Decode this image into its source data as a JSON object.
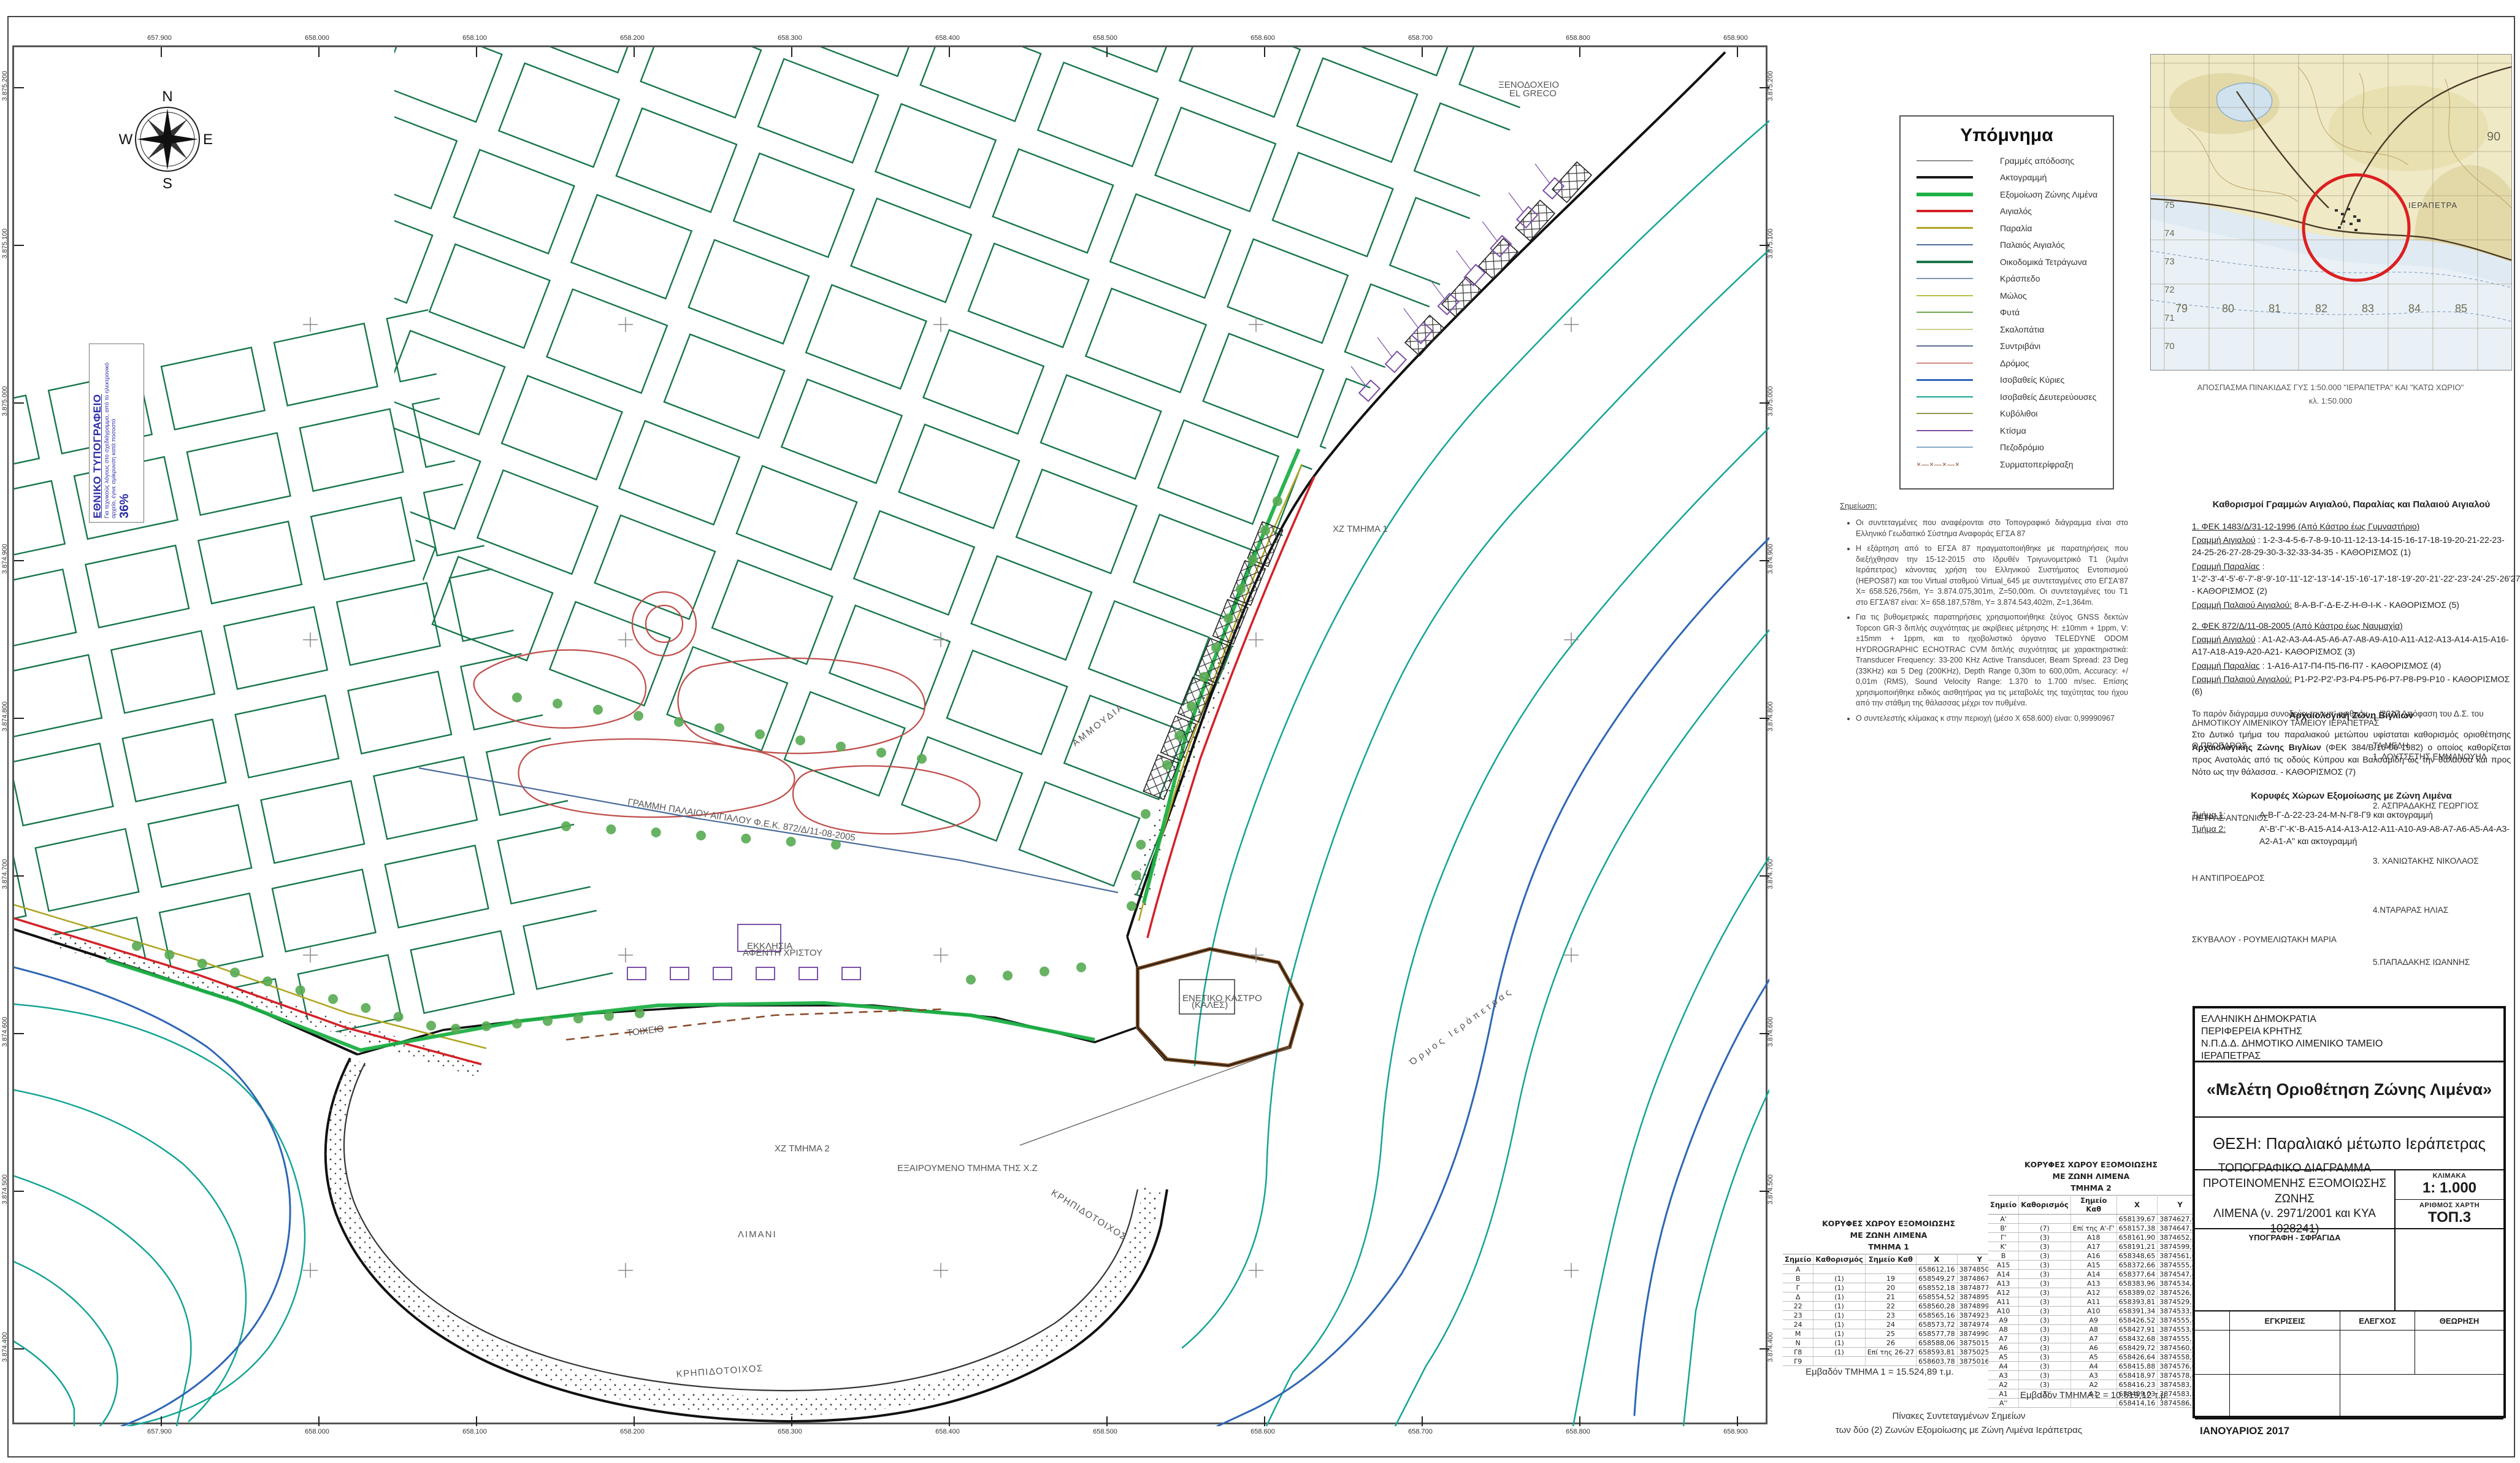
{
  "map": {
    "ticks_x": [
      "657.900",
      "658.000",
      "658.100",
      "658.200",
      "658.300",
      "658.400",
      "658.500",
      "658.600",
      "658.700",
      "658.800",
      "658.900"
    ],
    "ticks_y": [
      "3.875.200",
      "3.875.100",
      "3.875.000",
      "3.874.900",
      "3.874.800",
      "3.874.700",
      "3.874.600",
      "3.874.500",
      "3.874.400"
    ],
    "compass": {
      "n": "N",
      "e": "E",
      "s": "S",
      "w": "W"
    },
    "labels": {
      "limani": "ΛΙΜΑΝΙ",
      "ammoudia": "ΑΜΜΟΥΔΙΑ",
      "xz1": "ΧΖ ΤΜΗΜΑ 1",
      "xz2": "ΧΖ ΤΜΗΜΑ 2",
      "exair": "ΕΞΑΙΡΟΥΜΕΝΟ ΤΜΗΜΑ ΤΗΣ Χ.Ζ",
      "ormos": "Όρμος Ιεράπετρας",
      "krip1": "ΚΡΗΠΙΔΟΤΟΙΧΟΣ",
      "krip2": "ΚΡΗΠΙΔΟΤΟΙΧΟΣ",
      "hotel1": "ΞΕΝΟΔΟΧΕΙΟ",
      "hotel2": "EL GRECO",
      "kastro1": "ΕΝΕΤΙΚΟ ΚΑΣΤΡΟ",
      "kastro2": "(ΚΑΛΕΣ)",
      "church1": "ΕΚΚΛΗΣΙΑ",
      "church2": "ΑΦΕΝΤΗ ΧΡΙΣΤΟΥ",
      "palaios": "ΓΡΑΜΜΗ ΠΑΛΑΙΟΥ ΑΙΓΙΑΛΟΥ  Φ.Ε.Κ. 872/Δ/11-08-2005",
      "toixeio": "ΤΟΙΧΕΙΟ"
    }
  },
  "stamp": {
    "title": "ΕΘΝΙΚΟ ΤΥΠΟΓΡΑΦΕΙΟ",
    "body": "Για τεχνικούς λόγους στο σχεδιάγραμμα, από το ηλεκτρονικό αρχείο, έγινε σμίκρυνση κατά ποσοστό",
    "pct": "36%"
  },
  "legend": {
    "title": "Υπόμνημα",
    "items": [
      {
        "label": "Γραμμές απόδοσης",
        "color": "#8f8f8f",
        "weight": 2,
        "style": "solid"
      },
      {
        "label": "Ακτογραμμή",
        "color": "#1a1a1a",
        "weight": 4,
        "style": "solid"
      },
      {
        "label": "Εξομοίωση Ζώνης Λιμένα",
        "color": "#1db046",
        "weight": 6,
        "style": "solid"
      },
      {
        "label": "Αιγιαλός",
        "color": "#d42127",
        "weight": 4,
        "style": "solid"
      },
      {
        "label": "Παραλία",
        "color": "#b0a623",
        "weight": 3,
        "style": "solid"
      },
      {
        "label": "Παλαιός Αιγιαλός",
        "color": "#4a6d9b",
        "weight": 2,
        "style": "solid"
      },
      {
        "label": "Οικοδομικά Τετράγωνα",
        "color": "#17764a",
        "weight": 4,
        "style": "solid"
      },
      {
        "label": "Κράσπεδο",
        "color": "#7d97b5",
        "weight": 2,
        "style": "solid"
      },
      {
        "label": "Μώλος",
        "color": "#b9c145",
        "weight": 2,
        "style": "solid"
      },
      {
        "label": "Φυτά",
        "color": "#68a94d",
        "weight": 2,
        "style": "solid"
      },
      {
        "label": "Σκαλοπάτια",
        "color": "#cbcf8d",
        "weight": 2,
        "style": "solid"
      },
      {
        "label": "Συντριβάνι",
        "color": "#5d6d92",
        "weight": 2,
        "style": "solid"
      },
      {
        "label": "Δρόμος",
        "color": "#d48a86",
        "weight": 2,
        "style": "solid"
      },
      {
        "label": "Ισοβαθείς Κύριες",
        "color": "#2e66b5",
        "weight": 3,
        "style": "solid"
      },
      {
        "label": "Ισοβαθείς Δευτερεύουσες",
        "color": "#14a493",
        "weight": 2,
        "style": "solid"
      },
      {
        "label": "Κυβόλιθοι",
        "color": "#97984e",
        "weight": 2,
        "style": "solid"
      },
      {
        "label": "Κτίσμα",
        "color": "#7b4fa6",
        "weight": 2,
        "style": "solid"
      },
      {
        "label": "Πεζοδρόμιο",
        "color": "#88a9c8",
        "weight": 2,
        "style": "solid"
      },
      {
        "label": "Συρματοπερίφραξη",
        "color": "#8a4a2a",
        "weight": 2,
        "style": "fence"
      }
    ]
  },
  "inset": {
    "caption1": "ΑΠΟΣΠΑΣΜΑ ΠΙΝΑΚΙΔΑΣ ΓΥΣ 1:50.000 \"ΙΕΡΑΠΕΤΡΑ\" ΚΑΙ \"ΚΑΤΩ ΧΩΡΙΟ\"",
    "caption2": "κλ. 1:50.000",
    "bottom_numbers": [
      "79",
      "80",
      "81",
      "82",
      "83",
      "84",
      "85"
    ],
    "left_numbers": [
      "75",
      "74",
      "73",
      "72",
      "71",
      "70"
    ],
    "right_number": "90",
    "town_label": "ΙΕΡΑΠΕΤΡΑ"
  },
  "notes": {
    "heading": "Σημείωση:",
    "bullets": [
      "Οι συντεταγμένες που αναφέρονται στο Τοπογραφικό διάγραμμα είναι στο Ελληνικό Γεωδαιτικό Σύστημα Αναφοράς ΕΓΣΑ 87",
      "Η εξάρτηση από το ΕΓΣΑ 87 πραγματοποιήθηκε με παρατηρήσεις που διεξήχθησαν την 15-12-2015 στο Ιδρυθέν Τριγωνομετρικό Τ1 (λιμάνι Ιεράπετρας) κάνοντας χρήση του Ελληνικού Συστήματος Εντοπισμού (HEPOS87) και του Virtual σταθμού Virtual_645 με συντεταγμένες στο ΕΓΣΑ'87 X= 658.526,756m, Y= 3.874.075,301m, Z=50,00m. Οι συντεταγμένες του Τ1 στο ΕΓΣΑ'87 είναι: X= 658.187,578m, Y= 3.874.543,402m, Z=1,364m.",
      "Για τις βυθομετρικές παρατηρήσεις χρησιμοποιήθηκε ζεύγος GNSS δεκτών Topcon GR-3 διπλής συχνότητας με ακρίβειες μέτρησης H: ±10mm + 1ppm, V: ±15mm + 1ppm, και το ηχοβολιστικό όργανο TELEDYNE ODOM HYDROGRAPHIC ECHOTRAC CVM διπλής συχνότητας με χαρακτηριστικά: Transducer Frequency: 33-200 KHz Active Transducer, Beam Spread: 23 Deg (33KHz) και 5 Deg (200KHz), Depth Range 0,30m to 600,00m, Accuracy: +/ 0,01m (RMS), Sound Velocity Range: 1.370 to 1.700 m/sec. Επίσης χρησιμοποιήθηκε ειδικός αισθητήρας για τις μεταβολές της ταχύτητας του ήχου από την στάθμη της θάλασσας μέχρι τον πυθμένα.",
      "Ο συντελεστής κλίμακας κ στην περιοχή (μέσο X 658.600) είναι: 0,99990967"
    ]
  },
  "fek": {
    "title": "Καθορισμοί Γραμμών Αιγιαλού, Παραλίας και Παλαιού Αιγιαλού",
    "s1_heading": "1. ΦΕΚ 1483/Δ/31-12-1996 (Από Κάστρο έως Γυμναστήριο)",
    "s1_l1_label": "Γραμμή Αιγιαλού",
    "s1_l1_text": " : 1-2-3-4-5-6-7-8-9-10-11-12-13-14-15-16-17-18-19-20-21-22-23-24-25-26-27-28-29-30-3-32-33-34-35 - ΚΑΘΟΡΙΣΜΟΣ (1)",
    "s1_l2_label": "Γραμμή Παραλίας",
    "s1_l2_text": " : 1'-2'-3'-4'-5'-6'-7'-8'-9'-10'-11'-12'-13'-14'-15'-16'-17'-18'-19'-20'-21'-22'-23'-24'-25'-26'27' - ΚΑΘΟΡΙΣΜΟΣ (2)",
    "s1_l3_label": "Γραμμή Παλαιού Αιγιαλού:",
    "s1_l3_text": " 8-Α-Β-Γ-Δ-Ε-Ζ-Η-Θ-Ι-Κ - ΚΑΘΟΡΙΣΜΟΣ (5)",
    "s2_heading": "2. ΦΕΚ 872/Δ/11-08-2005 (Από Κάστρο έως Ναυμαχία)",
    "s2_l1_label": "Γραμμή Αιγιαλού",
    "s2_l1_text": " :  Α1-Α2-Α3-Α4-Α5-Α6-Α7-Α8-Α9-Α10-Α11-Α12-Α13-Α14-Α15-Α16-Α17-Α18-Α19-Α20-Α21- ΚΑΘΟΡΙΣΜΟΣ (3)",
    "s2_l2_label": "Γραμμή Παραλίας",
    "s2_l2_text": " : 1-Α16-Α17-Π4-Π5-Π6-Π7 - ΚΑΘΟΡΙΣΜΟΣ (4)",
    "s2_l3_label": "Γραμμή Παλαιού Αιγιαλού:",
    "s2_l3_text": " Ρ1-Ρ2-Ρ2'-Ρ3-Ρ4-Ρ5-Ρ6-Ρ7-Ρ8-Ρ9-Ρ10 - ΚΑΘΟΡΙΣΜΟΣ (6)",
    "arch_title": "Αρχαιολογική Ζώνη Βιγλίων",
    "arch_body_1": "Στο Δυτικό τμήμα του παραλιακού μετώπου υφίσταται καθορισμός οριοθέτησης ",
    "arch_body_bold": "Αρχαιολογικής Ζώνης Βιγλίων ",
    "arch_body_2": "(ΦΕΚ 384/Β/16-06-1982) ο οποίος καθορίζεται προς Ανατολάς από τις οδούς Κύπρου και Βαλσαμίδη ως την θάλασσα και προς Νότο ως την θάλασσα. - ΚΑΘΟΡΙΣΜΟΣ (7)",
    "peaks_title": "Κορυφές Χώρων Εξομοίωσης με Ζώνη Λιμένα",
    "p1_label": "Τμήμα  1:",
    "p1_text": "Α-Β-Γ-Δ-22-23-24-Μ-Ν-Γ8-Γ9 και ακτογραμμή",
    "p2_label": "Τμήμα  2:",
    "p2_text": "Α'-Β'-Γ'-Κ'-Β-Α15-Α14-Α13-Α12-Α11-Α10-Α9-Α8-Α7-Α6-Α5-Α4-Α3-Α2-Α1-Α'' και ακτογραμμή"
  },
  "signatures": {
    "intro1": "Το παρόν διάγραμμα συνοδεύει την υπ' αριθμόν __/2017 Απόφαση του Δ.Σ. του",
    "intro2": "ΔΗΜΟΤΙΚΟΥ ΛΙΜΕΝΙΚΟΥ ΤΑΜΕΙΟΥ ΙΕΡΑΠΕΤΡΑΣ",
    "president_title": "Ο ΠΡΟΕΔΡΟΣ",
    "president_name": "ΠΕΤΡΑΣ ΑΝΤΩΝΙΟΣ",
    "vice_title": "Η ΑΝΤΙΠΡΟΕΔΡΟΣ",
    "vice_name": "ΣΚΥΒΑΛΟΥ - ΡΟΥΜΕΛΙΩΤΑΚΗ ΜΑΡΙΑ",
    "members_title": "ΤΑ ΜΕΛΗ",
    "members": [
      "1. ΛΟΥΤΣΕΤΗΣ ΕΜΜΑΝΟΥΗΛ",
      "2. ΑΣΠΡΑΔΑΚΗΣ ΓΕΩΡΓΙΟΣ",
      "3. ΧΑΝΙΩΤΑΚΗΣ ΝΙΚΟΛΑΟΣ",
      "4.ΝΤΑΡΑΡΑΣ ΗΛΙΑΣ",
      "5.ΠΑΠΑΔΑΚΗΣ ΙΩΑΝΝΗΣ"
    ]
  },
  "tables": {
    "columns": [
      "Σημείο",
      "Καθορισμός",
      "Σημείο Καθ",
      "X",
      "Y"
    ],
    "t1": {
      "title1": "ΚΟΡΥΦΕΣ ΧΩΡΟΥ ΕΞΟΜΟΙΩΣΗΣ",
      "title2": "ΜΕ ΖΩΝΗ ΛΙΜΕΝΑ",
      "title3": "ΤΜΗΜΑ 1",
      "rows": [
        [
          "Α",
          "",
          "",
          "658612,16",
          "3874850,98"
        ],
        [
          "Β",
          "(1)",
          "19",
          "658549,27",
          "3874867,70"
        ],
        [
          "Γ",
          "(1)",
          "20",
          "658552,18",
          "3874877,86"
        ],
        [
          "Δ",
          "(1)",
          "21",
          "658554,52",
          "3874895,15"
        ],
        [
          "22",
          "(1)",
          "22",
          "658560,28",
          "3874899,80"
        ],
        [
          "23",
          "(1)",
          "23",
          "658565,16",
          "3874923,81"
        ],
        [
          "24",
          "(1)",
          "24",
          "658573,72",
          "3874974,08"
        ],
        [
          "Μ",
          "(1)",
          "25",
          "658577,78",
          "3874990,64"
        ],
        [
          "Ν",
          "(1)",
          "26",
          "658588,06",
          "3875015,24"
        ],
        [
          "Γ8",
          "(1)",
          "Επί της 26-27",
          "658593,81",
          "3875025,29"
        ],
        [
          "Γ9",
          "",
          "",
          "658603,78",
          "3875016,38"
        ]
      ],
      "area": "Εμβαδόν ΤΜΗΜΑ 1 = 15.524,89 τ.μ."
    },
    "t2": {
      "title1": "ΚΟΡΥΦΕΣ ΧΩΡΟΥ ΕΞΟΜΟΙΩΣΗΣ",
      "title2": "ΜΕ ΖΩΝΗ ΛΙΜΕΝΑ",
      "title3": "ΤΜΗΜΑ 2",
      "rows": [
        [
          "Α'",
          "",
          "",
          "658139,67",
          "3874627,00"
        ],
        [
          "Β'",
          "(7)",
          "Επί της Α'-Γ'",
          "658157,38",
          "3874647,21"
        ],
        [
          "Γ'",
          "(3)",
          "Α18",
          "658161,90",
          "3874652,36"
        ],
        [
          "Κ'",
          "(3)",
          "Α17",
          "658191,21",
          "3874599,98"
        ],
        [
          "Β",
          "(3)",
          "Α16",
          "658348,65",
          "3874561,61"
        ],
        [
          "Α15",
          "(3)",
          "Α15",
          "658372,66",
          "3874555,41"
        ],
        [
          "Α14",
          "(3)",
          "Α14",
          "658377,64",
          "3874547,43"
        ],
        [
          "Α13",
          "(3)",
          "Α13",
          "658383,96",
          "3874534,49"
        ],
        [
          "Α12",
          "(3)",
          "Α12",
          "658389,02",
          "3874526,32"
        ],
        [
          "Α11",
          "(3)",
          "Α11",
          "658393,81",
          "3874529,14"
        ],
        [
          "Α10",
          "(3)",
          "Α10",
          "658391,34",
          "3874533,57"
        ],
        [
          "Α9",
          "(3)",
          "Α9",
          "658426,52",
          "3874555,42"
        ],
        [
          "Α8",
          "(3)",
          "Α8",
          "658427,91",
          "3874553,08"
        ],
        [
          "Α7",
          "(3)",
          "Α7",
          "658432,68",
          "3874555,75"
        ],
        [
          "Α6",
          "(3)",
          "Α6",
          "658429,72",
          "3874560,68"
        ],
        [
          "Α5",
          "(3)",
          "Α5",
          "658426,64",
          "3874558,90"
        ],
        [
          "Α4",
          "(3)",
          "Α4",
          "658415,88",
          "3874576,69"
        ],
        [
          "Α3",
          "(3)",
          "Α3",
          "658418,97",
          "3874578,44"
        ],
        [
          "Α2",
          "(3)",
          "Α2",
          "658416,23",
          "3874583,12"
        ],
        [
          "Α1",
          "(3)",
          "Α1",
          "658409,03",
          "3874583,88"
        ],
        [
          "Α''",
          "",
          "",
          "658414,16",
          "3874586,77"
        ]
      ],
      "area": "Εμβαδόν ΤΜΗΜΑ 2 = 10.619,12 τ.μ."
    },
    "caption1": "Πίνακες Συντεταγμένων Σημείων",
    "caption2": "των δύο (2) Ζωνών Εξομοίωσης με Ζώνη Λιμένα Ιεράπετρας"
  },
  "titleblock": {
    "agency": [
      "ΕΛΛΗΝΙΚΗ ΔΗΜΟΚΡΑΤΙΑ",
      "ΠΕΡΙΦΕΡΕΙΑ ΚΡΗΤΗΣ",
      "Ν.Π.Δ.Δ. ΔΗΜΟΤΙΚΟ ΛΙΜΕΝΙΚΟ ΤΑΜΕΙΟ",
      "ΙΕΡΑΠΕΤΡΑΣ"
    ],
    "project": "«Μελέτη  Οριοθέτηση Ζώνης Λιμένα»",
    "location": "ΘΕΣΗ: Παραλιακό μέτωπο Ιεράπετρας",
    "drawing1": "ΤΟΠΟΓΡΑΦΙΚΟ ΔΙΑΓΡΑΜΜΑ",
    "drawing2": "ΠΡΟΤΕΙΝΟΜΕΝΗΣ ΕΞΟΜΟΙΩΣΗΣ ΖΩΝΗΣ",
    "drawing3": "ΛΙΜΕΝΑ (ν. 2971/2001 και ΚΥΑ 1028241)",
    "scale_label": "ΚΛΙΜΑΚΑ",
    "scale_value": "1: 1.000",
    "mapno_label": "ΑΡΙΘΜΟΣ ΧΑΡΤΗ",
    "mapno_value": "ΤΟΠ.3",
    "sig_label": "ΥΠΟΓΡΑΦΗ - ΣΦΡΑΓΙΔΑ",
    "appr1": "ΕΓΚΡΙΣΕΙΣ",
    "appr2": "ΕΛΕΓΧΟΣ",
    "appr3": "ΘΕΩΡΗΣΗ",
    "date": "ΙΑΝΟΥΑΡΙΟΣ 2017"
  }
}
